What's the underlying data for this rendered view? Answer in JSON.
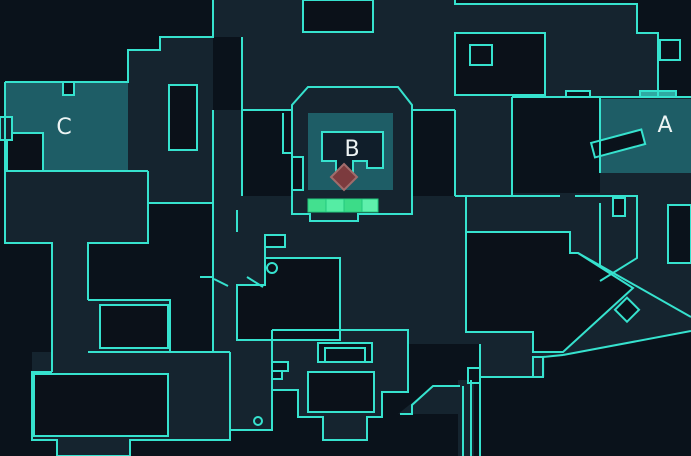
{
  "map": {
    "name": "tactical-minimap",
    "canvas": {
      "w": 691,
      "h": 456
    },
    "colors": {
      "bg": "#0A121B",
      "walkable": "#15242F",
      "obstacle": "#0B1119",
      "wall": "#36E2CE",
      "site": "#1E5D66",
      "inner": "#101E2A",
      "door_teal": "#2FA9A2",
      "spike_fill": "#7C3B3E",
      "spike_stroke": "#A06C6C",
      "label": "#EDF4F4",
      "green_stroke": "#22C97E"
    },
    "site_labels": [
      {
        "name": "site-label-c",
        "text": "C",
        "x": 64,
        "y": 134
      },
      {
        "name": "site-label-b",
        "text": "B",
        "x": 352,
        "y": 156
      },
      {
        "name": "site-label-a",
        "text": "A",
        "x": 665,
        "y": 132
      }
    ],
    "site_highlights": [
      {
        "name": "site-c-zone",
        "x": 5,
        "y": 82,
        "w": 123,
        "h": 89
      },
      {
        "name": "site-b-zone",
        "x": 308,
        "y": 113,
        "w": 85,
        "h": 77
      },
      {
        "name": "site-a-zone",
        "x": 600,
        "y": 99,
        "w": 91,
        "h": 74
      }
    ],
    "walkable_polys": [
      "213,0 455,0 455,4 637,4 637,33 658,33 658,97 512,97 512,110 242,110 242,37 213,37",
      "128,50 160,50 160,37 213,37 213,110 128,110",
      "5,82 213,82 213,171 148,171 148,243 88,243 88,372 52,372 52,243 5,243",
      "88,300 170,300 170,352 88,352",
      "32,352 230,352 230,440 130,440 130,456 57,456 57,440 32,440 32,372",
      "213,110 242,110 242,196 213,196",
      "213,196 466,196 466,344 408,344 408,330 272,330 272,430 230,430 230,352 213,352",
      "308,87 398,87 412,105 412,221 292,221 292,105",
      "455,110 512,110 512,196 455,196",
      "455,193 636,193 636,260 598,283 570,253 570,232 455,232",
      "600,97 691,97 691,331 600,267",
      "466,332 545,332 545,377 480,377 480,344 466,344",
      "570,253 578,253 691,317 691,331 563,355 545,355 545,332 570,332",
      "458,380 474,380 474,456 458,456",
      "398,414 433,386 458,386 458,414",
      "272,330 408,330 408,392 382,392 382,417 367,417 367,440 323,440 323,417 298,417 298,390 272,390",
      "148,171 213,171 213,203 148,203"
    ],
    "black_polys": [
      {
        "name": "mid-obstacle",
        "pts": "265,258 340,258 340,340 237,340 237,285 265,285",
        "fill": "obstacle"
      },
      {
        "name": "garage-obstacle",
        "pts": "466,232 570,232 570,253 578,253 633,288 563,352 533,352 533,332 466,332",
        "fill": "obstacle"
      }
    ],
    "rects": [
      {
        "name": "spawn-top-obstacle",
        "x": 303,
        "y": 0,
        "w": 70,
        "h": 32,
        "fill": "obstacle"
      },
      {
        "name": "alink-obstacle",
        "x": 455,
        "y": 33,
        "w": 90,
        "h": 62,
        "fill": "obstacle"
      },
      {
        "name": "alink-obstacle-notch",
        "x": 470,
        "y": 45,
        "w": 22,
        "h": 20,
        "fill": "obstacle"
      },
      {
        "name": "c-annex-pillar",
        "x": 169,
        "y": 85,
        "w": 28,
        "h": 65,
        "fill": "obstacle"
      },
      {
        "name": "c-site-backroom",
        "x": 7,
        "y": 133,
        "w": 36,
        "h": 38,
        "fill": "obstacle"
      },
      {
        "name": "midleft-obstacle",
        "x": 100,
        "y": 305,
        "w": 68,
        "h": 43,
        "fill": "obstacle"
      },
      {
        "name": "bottomleft-obstacle",
        "x": 34,
        "y": 374,
        "w": 134,
        "h": 62,
        "fill": "obstacle"
      },
      {
        "name": "spawn-lower-obstacle",
        "x": 308,
        "y": 372,
        "w": 66,
        "h": 40,
        "fill": "obstacle"
      },
      {
        "name": "a-hook-box",
        "x": 613,
        "y": 198,
        "w": 12,
        "h": 18,
        "fill": "obstacle"
      },
      {
        "name": "right-edge-bite",
        "x": 668,
        "y": 205,
        "w": 23,
        "h": 58,
        "fill": "bg"
      },
      {
        "name": "topright-box",
        "x": 660,
        "y": 40,
        "w": 20,
        "h": 20,
        "fill": "bg"
      },
      {
        "name": "fountain-outer",
        "x": 318,
        "y": 343,
        "w": 54,
        "h": 19,
        "fill": "bg"
      },
      {
        "name": "fountain-inner",
        "x": 325,
        "y": 348,
        "w": 40,
        "h": 14,
        "fill": "none"
      },
      {
        "name": "spawn-crate-1",
        "x": 272,
        "y": 362,
        "w": 16,
        "h": 9,
        "fill": "bg"
      },
      {
        "name": "spawn-crate-2",
        "x": 272,
        "y": 371,
        "w": 10,
        "h": 8,
        "fill": "bg"
      },
      {
        "name": "c-wall-notch",
        "x": 63,
        "y": 82,
        "w": 11,
        "h": 13,
        "fill": "bg"
      },
      {
        "name": "c-left-box",
        "x": 0,
        "y": 117,
        "w": 12,
        "h": 23,
        "fill": "walkable"
      },
      {
        "name": "sewer-box",
        "x": 468,
        "y": 368,
        "w": 12,
        "h": 15,
        "fill": "bg"
      },
      {
        "name": "along-step-box",
        "x": 533,
        "y": 357,
        "w": 10,
        "h": 20,
        "fill": "walkable"
      },
      {
        "name": "a-door-marker-left",
        "x": 566,
        "y": 91,
        "w": 24,
        "h": 6,
        "fill": "bg"
      },
      {
        "name": "a-door-marker-right",
        "x": 640,
        "y": 91,
        "w": 36,
        "h": 6,
        "fill": "door_teal"
      },
      {
        "name": "mid-wall-box",
        "x": 265,
        "y": 235,
        "w": 20,
        "h": 12,
        "fill": "bg"
      },
      {
        "name": "b-left-box",
        "x": 292,
        "y": 157,
        "w": 11,
        "h": 33,
        "fill": "bg"
      }
    ],
    "b_structure": {
      "outline": "308,87 398,87 412,105 412,214 358,214 358,221 310,221 310,214 292,214 292,105",
      "inner": "322,132 383,132 383,168 367,168 367,161 353,161 353,175 336,175 336,161 322,161"
    },
    "green_crates": [
      {
        "x": 308,
        "y": 199,
        "w": 18,
        "h": 13,
        "fill": "#43E08F"
      },
      {
        "x": 326,
        "y": 199,
        "w": 18,
        "h": 13,
        "fill": "#55EDA4"
      },
      {
        "x": 344,
        "y": 199,
        "w": 18,
        "h": 13,
        "fill": "#3CDC88"
      },
      {
        "x": 362,
        "y": 199,
        "w": 16,
        "h": 13,
        "fill": "#5FF0AC"
      }
    ],
    "spike_marker": {
      "name": "spike-marker",
      "pts": "344,164 357,177 344,190 331,177"
    },
    "rotated_crates": [
      {
        "name": "a-site-crate",
        "x": 592,
        "y": 136,
        "w": 52,
        "h": 15,
        "rotate": "-15 618 143"
      },
      {
        "name": "along-crate",
        "x": 619,
        "y": 301,
        "w": 17,
        "h": 17,
        "rotate": "45 627 309"
      }
    ],
    "door_circles": [
      {
        "name": "mid-door-circle",
        "cx": 272,
        "cy": 268,
        "r": 5
      },
      {
        "name": "bottom-door-circle",
        "cx": 258,
        "cy": 421,
        "r": 4
      }
    ],
    "door_lines": [
      "247,277 263,287",
      "214,279 228,286"
    ],
    "wall_lines": [
      "5,82 128,82 128,50 160,50 160,37 213,37 213,0",
      "242,196 242,37",
      "242,110 292,110",
      "412,110 455,110",
      "455,110 455,196",
      "512,97 512,196",
      "512,97 691,97",
      "455,0 455,4 637,4 637,33 658,33 658,97",
      "5,82 5,243 52,243 52,372",
      "5,171 148,171",
      "148,171 148,243 88,243 88,300",
      "88,300 170,300 170,352",
      "52,372 32,372 32,440 57,440 57,456 130,456 130,440 230,440 230,352",
      "88,352 230,352",
      "213,110 213,277",
      "200,277 213,277",
      "213,277 213,352",
      "148,203 213,203",
      "237,210 237,232",
      "265,247 265,258",
      "230,352 230,430 272,430 272,390",
      "466,196 466,232",
      "455,196 560,196",
      "575,196 636,196",
      "613,196 637,196 637,258 600,281",
      "600,97 600,173",
      "600,203 600,267",
      "578,253 691,317",
      "563,355 691,331",
      "480,377 533,377",
      "543,357 563,355",
      "463,386 463,456",
      "471,380 471,456",
      "480,344 480,456",
      "460,386 433,386 412,405 412,414 400,414",
      "283,113 283,153 292,153",
      "272,330 408,330 408,392 382,392 382,417 367,417 367,440 323,440 323,417 298,417 298,390 272,390 272,330"
    ]
  }
}
